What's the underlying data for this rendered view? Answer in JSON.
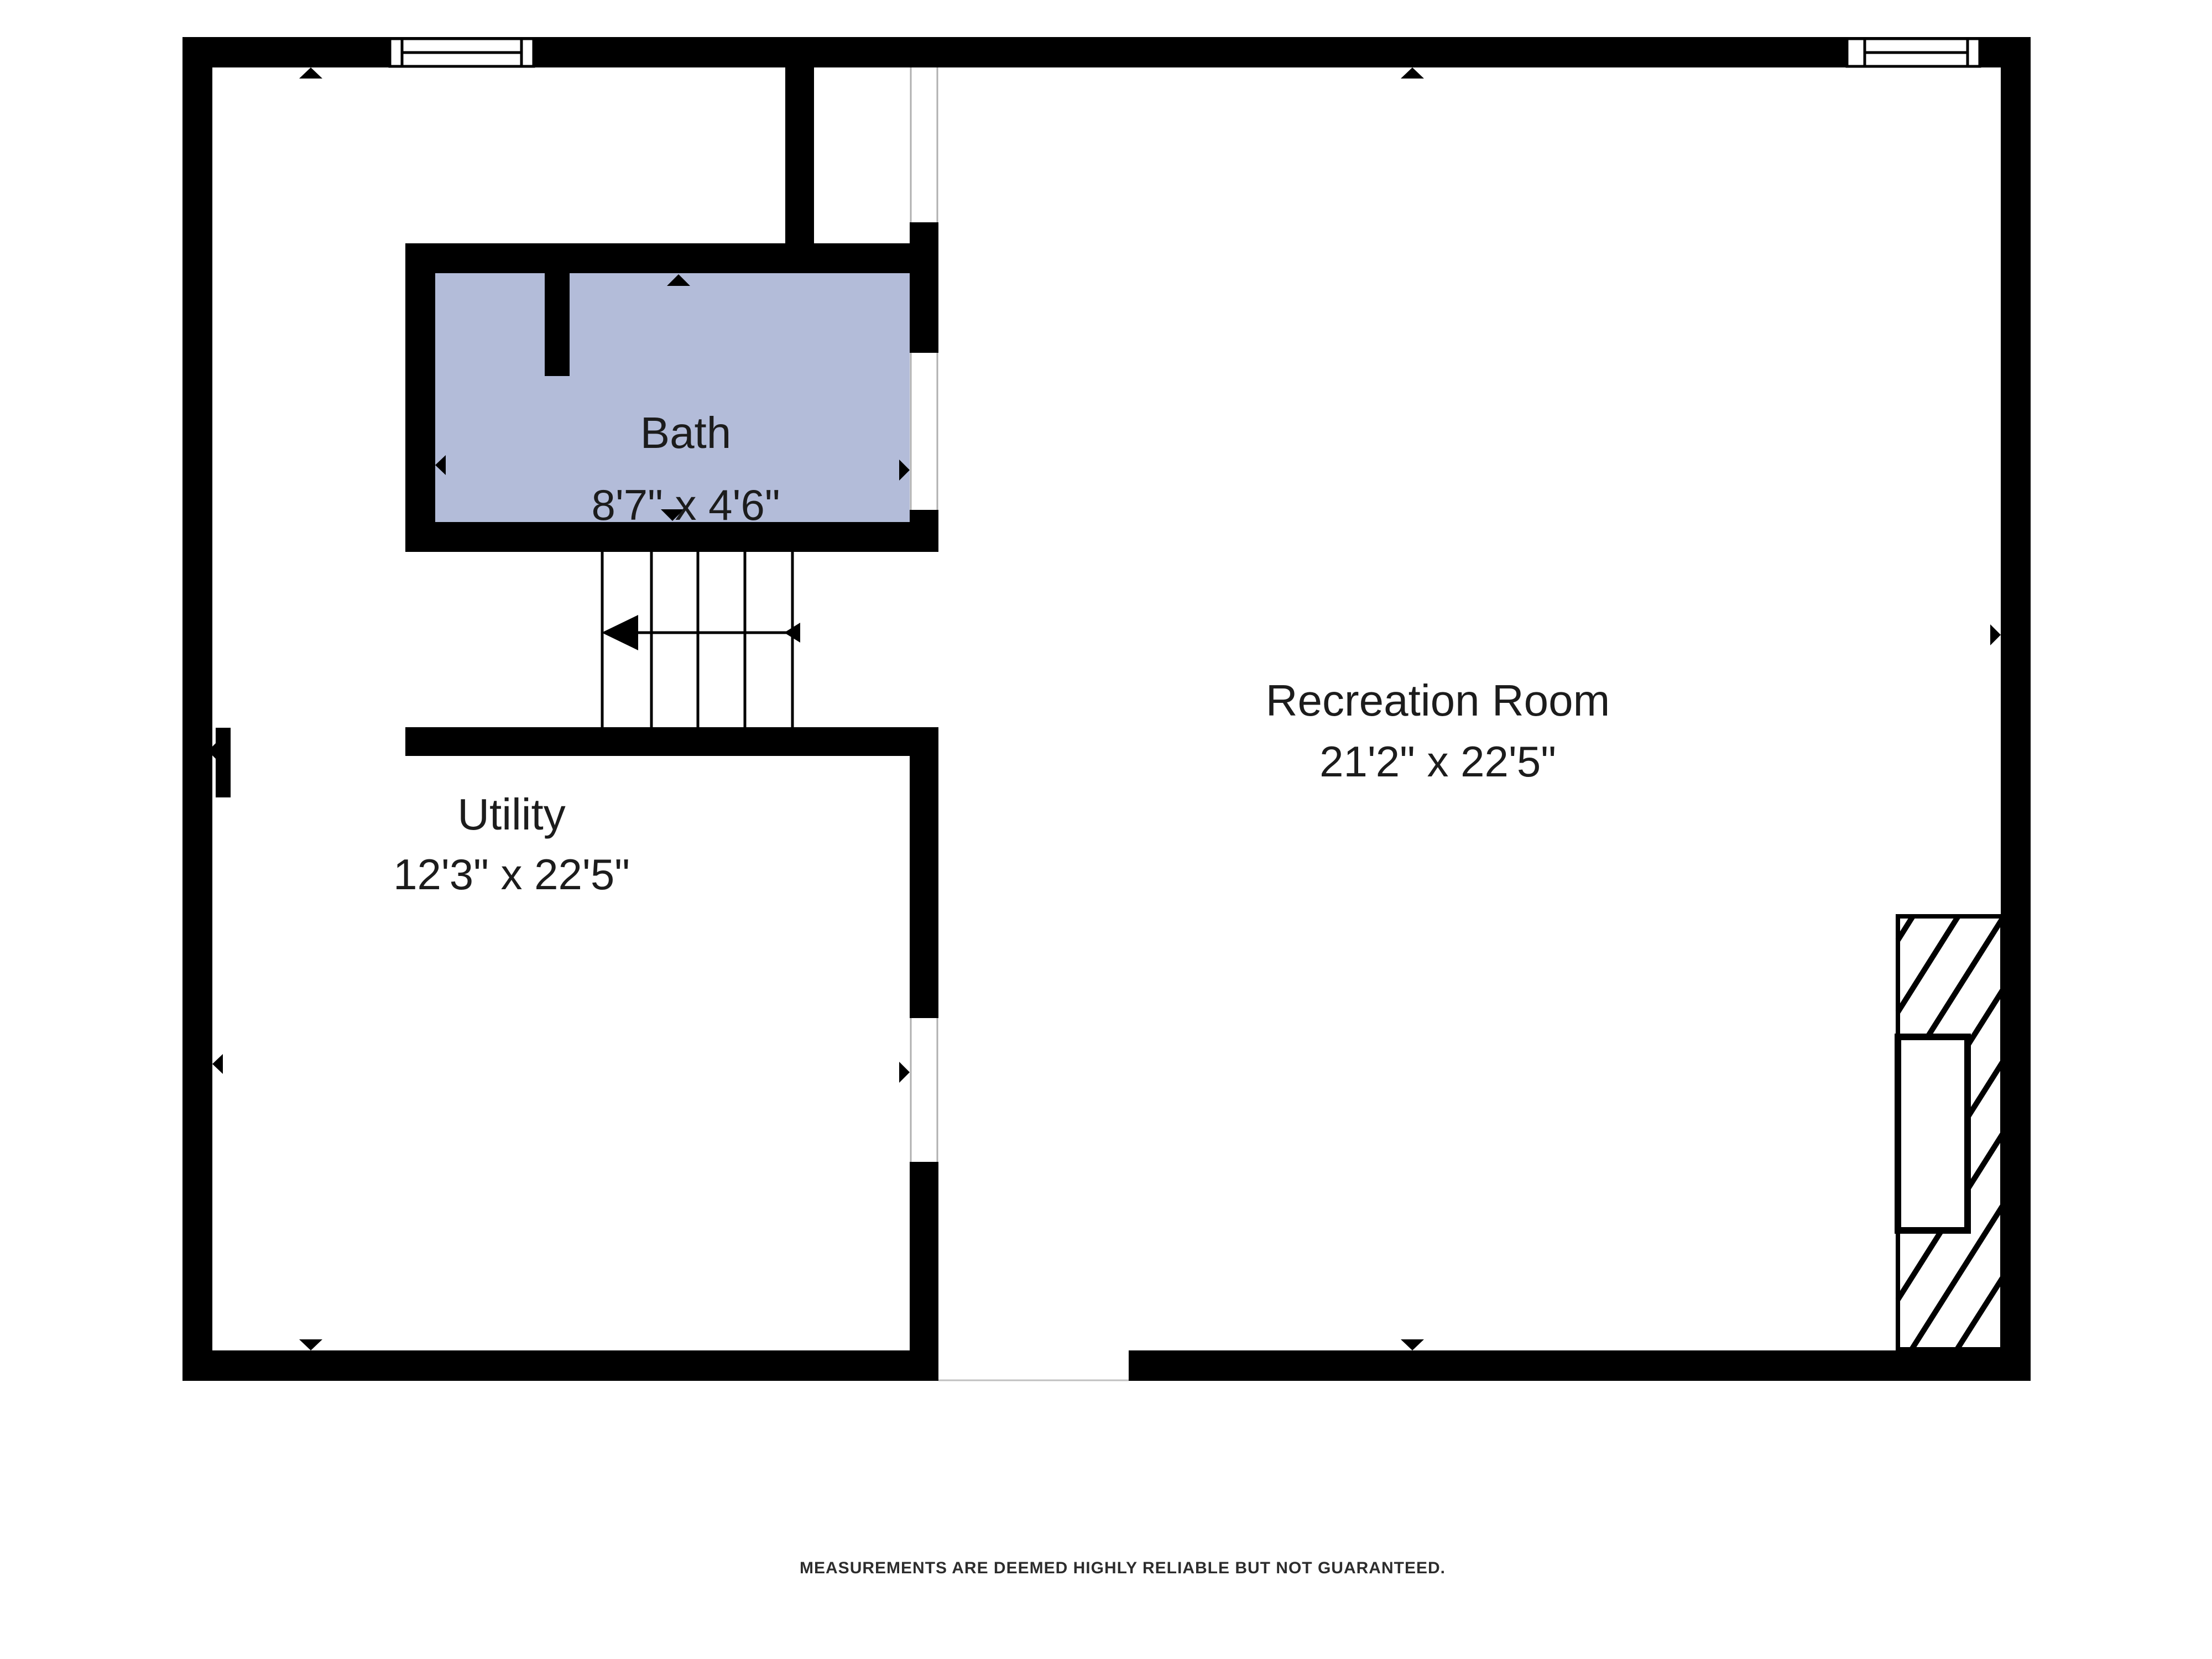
{
  "floorplan": {
    "rooms": [
      {
        "name": "Bath",
        "dimensions": "8'7\" x 4'6\""
      },
      {
        "name": "Recreation Room",
        "dimensions": "21'2\" x 22'5\""
      },
      {
        "name": "Utility",
        "dimensions": "12'3\" x 22'5\""
      }
    ],
    "disclaimer": "MEASUREMENTS ARE DEEMED HIGHLY RELIABLE BUT NOT GUARANTEED.",
    "colors": {
      "wall": "#000000",
      "bath_fill": "#b3bcd9",
      "background": "#ffffff",
      "opening_jamb": "#b0b0b0"
    }
  }
}
